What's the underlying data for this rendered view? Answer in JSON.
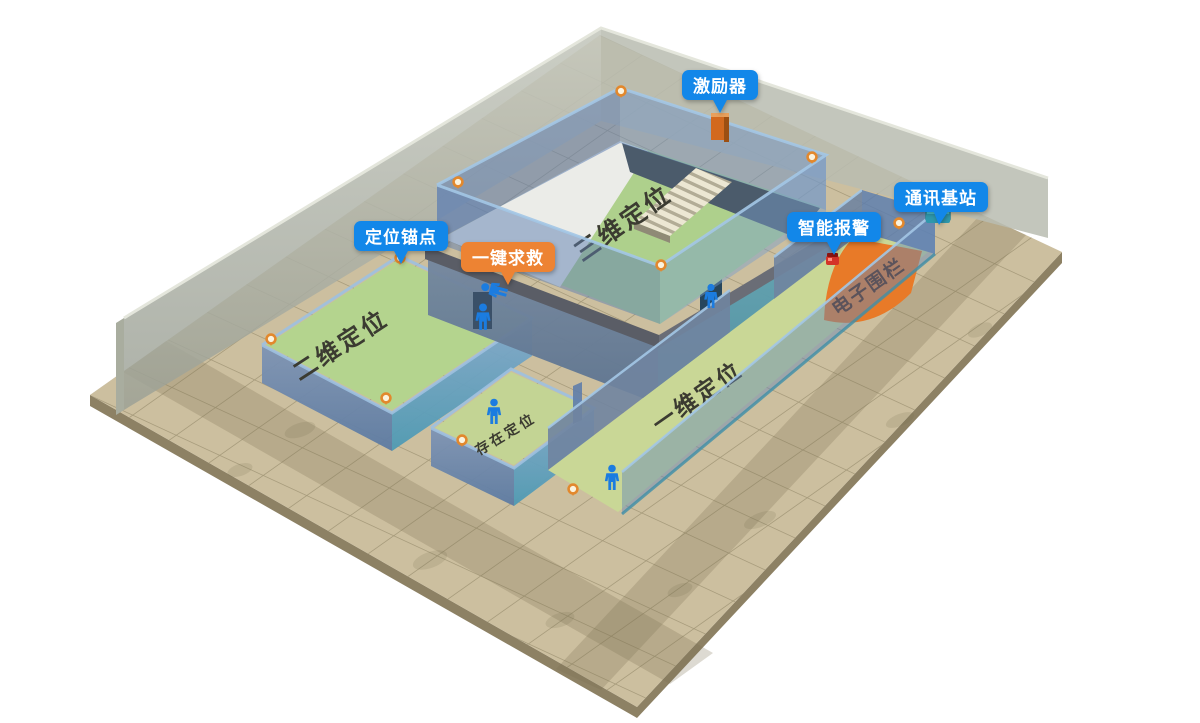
{
  "scene": {
    "title": "室内定位系统三维演示场景",
    "callouts": [
      {
        "id": "exciter",
        "label": "激励器",
        "color": "#1287e9"
      },
      {
        "id": "comm-base-station",
        "label": "通讯基站",
        "color": "#1287e9"
      },
      {
        "id": "smart-alarm",
        "label": "智能报警",
        "color": "#1287e9"
      },
      {
        "id": "positioning-anchor",
        "label": "定位锚点",
        "color": "#1287e9"
      },
      {
        "id": "sos-button",
        "label": "一键求救",
        "color": "#ed8333"
      }
    ],
    "zones": [
      {
        "id": "zone-3d",
        "label": "三维定位",
        "floor_color": "#aed08c"
      },
      {
        "id": "zone-2d",
        "label": "二维定位",
        "floor_color": "#b4d48e"
      },
      {
        "id": "zone-presence",
        "label": "存在定位",
        "floor_color": "#c3d494"
      },
      {
        "id": "zone-1d",
        "label": "一维定位",
        "floor_color": "#c9d796"
      },
      {
        "id": "zone-fence",
        "label": "电子围栏",
        "floor_color": "#e87a28"
      }
    ],
    "icons": [
      {
        "name": "person-icon",
        "color": "#1b7ce0"
      },
      {
        "name": "anchor-icon",
        "color": "#e2882d"
      },
      {
        "name": "exciter-device-icon",
        "color": "#d2691e"
      },
      {
        "name": "base-station-icon",
        "color": "#49c0d4"
      },
      {
        "name": "alarm-device-icon",
        "color": "#d43428"
      }
    ],
    "palette": {
      "ground": "#ccbf9f",
      "ground_edge": "#8d8164",
      "back_wall": "#b7bbb0",
      "glass_blue": "#6c8cb4",
      "teal_wall": "#5b9fb0",
      "callout_blue": "#1287e9",
      "callout_orange": "#ed8333"
    }
  }
}
